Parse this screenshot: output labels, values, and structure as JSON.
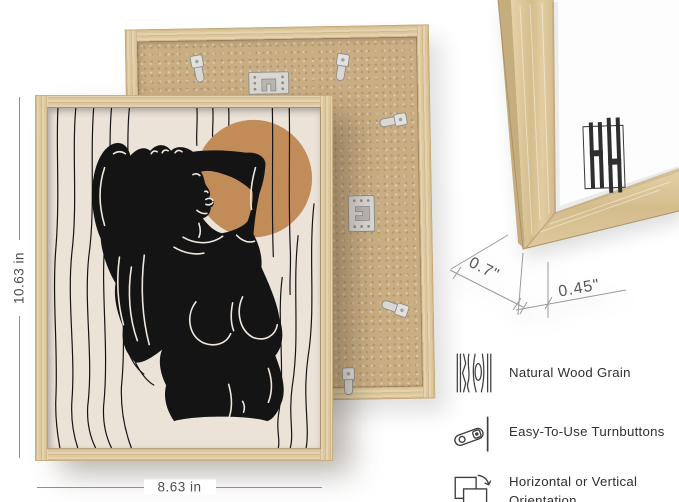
{
  "dimensions": {
    "height": "10.63 in",
    "width": "8.63 in",
    "depth": "0.7\"",
    "moulding_width": "0.45\""
  },
  "features": [
    {
      "icon": "wood-grain-icon",
      "label": "Natural Wood Grain"
    },
    {
      "icon": "turnbutton-icon",
      "label": "Easy-To-Use Turnbuttons"
    },
    {
      "icon": "orientation-icon",
      "label": "Horizontal or Vertical Orientation"
    }
  ],
  "colors": {
    "frame_wood": "#ddc79c",
    "mdf_back": "#c9ad83",
    "art_background": "#ebe2d8",
    "art_accent_circle": "#c28c59",
    "art_figure": "#141414",
    "annotation_line": "#8f8f8f",
    "annotation_text": "#4f4f4f",
    "feature_text": "#303030",
    "hardware_silver": "#d8d7d3"
  }
}
